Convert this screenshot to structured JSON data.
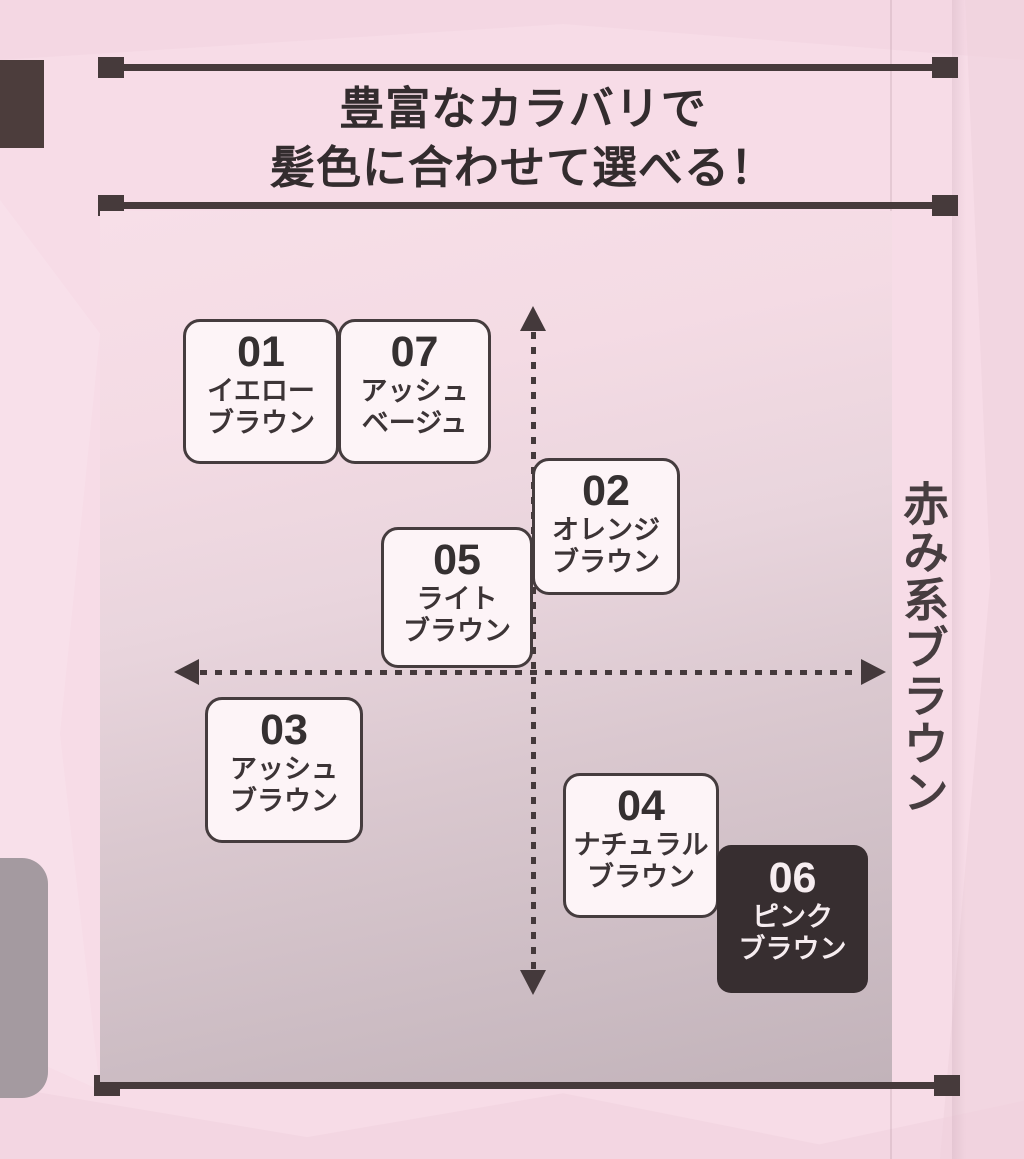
{
  "header": {
    "title_line1": "豊富なカラバリで",
    "title_line2": "髪色に合わせて選べる！"
  },
  "chart_data": {
    "type": "scatter",
    "title": "豊富なカラバリで髪色に合わせて選べる！",
    "x_axis": {
      "left_label": "黄み系ブラウン",
      "right_label": "赤み系ブラウン",
      "range": [
        -1,
        1
      ]
    },
    "y_axis": {
      "top_label": "明るい",
      "bottom_label": "暗い",
      "range": [
        -1,
        1
      ]
    },
    "grid": false,
    "points": [
      {
        "id": "01",
        "name": "イエローブラウン",
        "name_lines": [
          "イエロー",
          "ブラウン"
        ],
        "x": -0.68,
        "y": 0.82,
        "highlighted": false
      },
      {
        "id": "07",
        "name": "アッシュベージュ",
        "name_lines": [
          "アッシュ",
          "ベージュ"
        ],
        "x": -0.34,
        "y": 0.82,
        "highlighted": false
      },
      {
        "id": "02",
        "name": "オレンジブラウン",
        "name_lines": [
          "オレンジ",
          "ブラウン"
        ],
        "x": 0.2,
        "y": 0.44,
        "highlighted": false
      },
      {
        "id": "05",
        "name": "ライトブラウン",
        "name_lines": [
          "ライト",
          "ブラウン"
        ],
        "x": -0.22,
        "y": 0.22,
        "highlighted": false
      },
      {
        "id": "03",
        "name": "アッシュブラウン",
        "name_lines": [
          "アッシュ",
          "ブラウン"
        ],
        "x": -0.58,
        "y": -0.29,
        "highlighted": false
      },
      {
        "id": "04",
        "name": "ナチュラルブラウン",
        "name_lines": [
          "ナチュラル",
          "ブラウン"
        ],
        "x": 0.3,
        "y": -0.5,
        "highlighted": false
      },
      {
        "id": "06",
        "name": "ピンクブラウン",
        "name_lines": [
          "ピンク",
          "ブラウン"
        ],
        "x": 0.72,
        "y": -0.72,
        "highlighted": true
      }
    ],
    "colors": {
      "line_dark": "#463a3b",
      "box_fill": "#fdf4f7",
      "box_border": "#453c3e",
      "highlight_bg": "#372e30",
      "highlight_text": "#f6edf0",
      "page_pink": "#f7dce7"
    }
  }
}
